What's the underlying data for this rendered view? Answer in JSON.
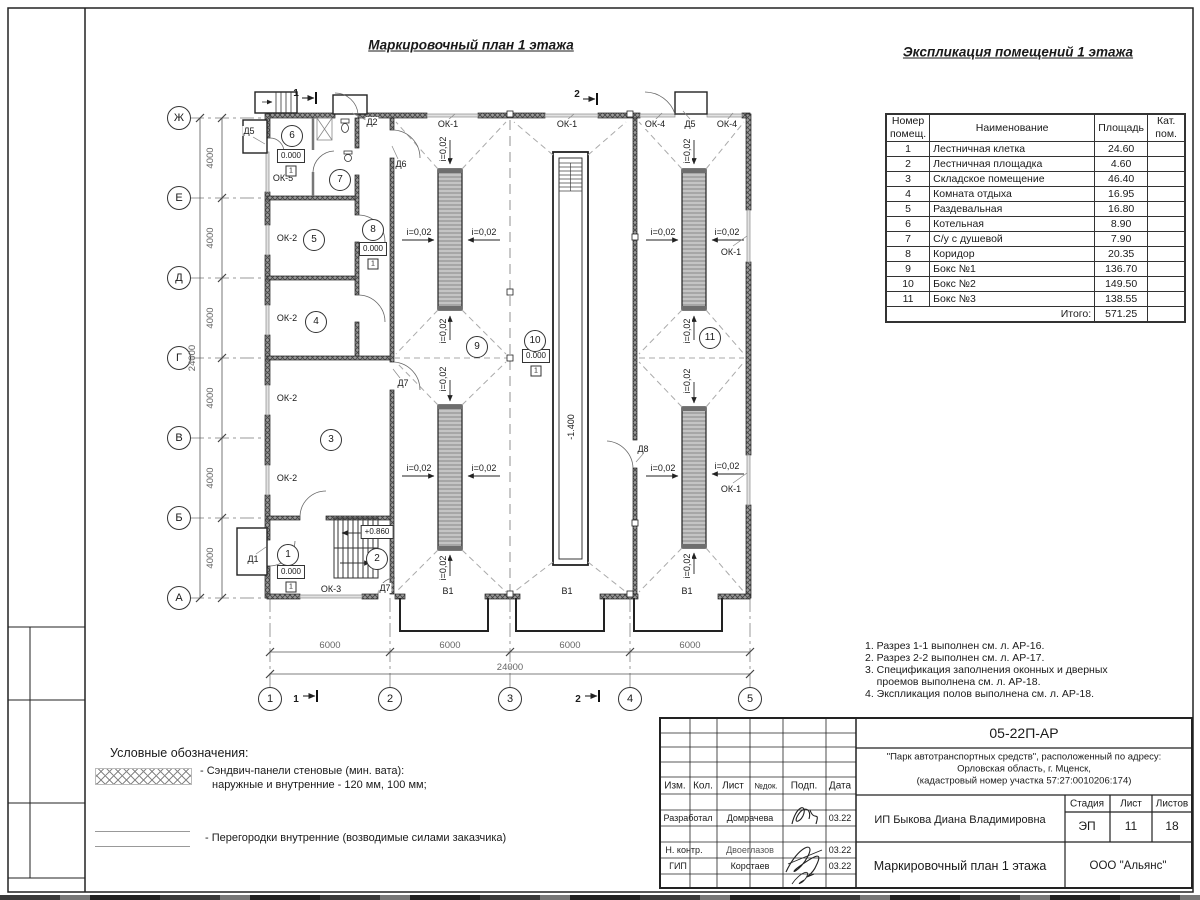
{
  "plan": {
    "title": "Маркировочный план 1 этажа",
    "labels": {
      "ok1": "ОК-1",
      "ok2": "ОК-2",
      "ok3": "ОК-3",
      "ok4": "ОК-4",
      "ok5": "ОК-5",
      "d1": "Д1",
      "d2": "Д2",
      "d5": "Д5",
      "d6": "Д6",
      "d7": "Д7",
      "d8": "Д8",
      "v1": "В1"
    },
    "slope": "i=0,02",
    "elevations": {
      "zero": "0.000",
      "stair": "+0.860",
      "pit": "-1.400",
      "floor_type": "1"
    },
    "rooms": [
      "1",
      "2",
      "3",
      "4",
      "5",
      "6",
      "7",
      "8",
      "9",
      "10",
      "11"
    ],
    "axes": {
      "rows": [
        "Ж",
        "Е",
        "Д",
        "Г",
        "В",
        "Б",
        "А"
      ],
      "cols": [
        "1",
        "2",
        "3",
        "4",
        "5"
      ]
    },
    "dims": {
      "step_v": "4000",
      "total_v": "24000",
      "step_h": "6000",
      "total_h": "24000"
    },
    "sections": {
      "s1": "1",
      "s2": "2"
    }
  },
  "explication": {
    "title": "Экспликация помещений 1 этажа",
    "headers": {
      "num": "Номер помещ.",
      "name": "Наименование",
      "area": "Площадь",
      "cat": "Кат. пом."
    },
    "rows": [
      {
        "num": "1",
        "name": "Лестничная клетка",
        "area": "24.60"
      },
      {
        "num": "2",
        "name": "Лестничная площадка",
        "area": "4.60"
      },
      {
        "num": "3",
        "name": "Складское помещение",
        "area": "46.40"
      },
      {
        "num": "4",
        "name": "Комната отдыха",
        "area": "16.95"
      },
      {
        "num": "5",
        "name": "Раздевальная",
        "area": "16.80"
      },
      {
        "num": "6",
        "name": "Котельная",
        "area": "8.90"
      },
      {
        "num": "7",
        "name": "С/у с душевой",
        "area": "7.90"
      },
      {
        "num": "8",
        "name": "Коридор",
        "area": "20.35"
      },
      {
        "num": "9",
        "name": "Бокс №1",
        "area": "136.70"
      },
      {
        "num": "10",
        "name": "Бокс №2",
        "area": "149.50"
      },
      {
        "num": "11",
        "name": "Бокс №3",
        "area": "138.55"
      }
    ],
    "total_label": "Итого:",
    "total_area": "571.25"
  },
  "notes": [
    "1. Разрез 1-1 выполнен см. л. АР-16.",
    "2. Разрез 2-2 выполнен см. л. АР-17.",
    "3. Спецификация заполнения оконных и дверных",
    "    проемов выполнена см. л. АР-18.",
    "4. Экспликация полов выполнена см. л. АР-18."
  ],
  "legend": {
    "title": "Условные обозначения:",
    "item1_line1": "- Сэндвич-панели стеновые (мин. вата):",
    "item1_line2": "наружные и внутренние - 120 мм, 100 мм;",
    "item2": "- Перегородки внутренние (возводимые силами заказчика)"
  },
  "stamp": {
    "doc_number": "05-22П-АР",
    "project_line1": "\"Парк автотранспортных средств\",  расположенный по адресу:",
    "project_line2": "Орловская область, г. Мценск,",
    "project_line3": "(кадастровый номер участка 57:27:0010206:174)",
    "client": "ИП Быкова Диана Владимировна",
    "stage_label": "Стадия",
    "sheet_label": "Лист",
    "sheets_label": "Листов",
    "stage": "ЭП",
    "sheet": "11",
    "sheets": "18",
    "drawing_title": "Маркировочный план 1 этажа",
    "company": "ООО \"Альянс\"",
    "col_izm": "Изм.",
    "col_kol": "Кол.",
    "col_list": "Лист",
    "col_ndok": "№док.",
    "col_podp": "Подп.",
    "col_data": "Дата",
    "role_dev": "Разработал",
    "name_dev": "Домрачева",
    "date_dev": "03.22",
    "role_ncontr": "Н. контр.",
    "name_ncontr": "Двоеглазов",
    "date_ncontr": "03.22",
    "role_gip": "ГИП",
    "name_gip": "Коротаев",
    "date_gip": "03.22"
  }
}
